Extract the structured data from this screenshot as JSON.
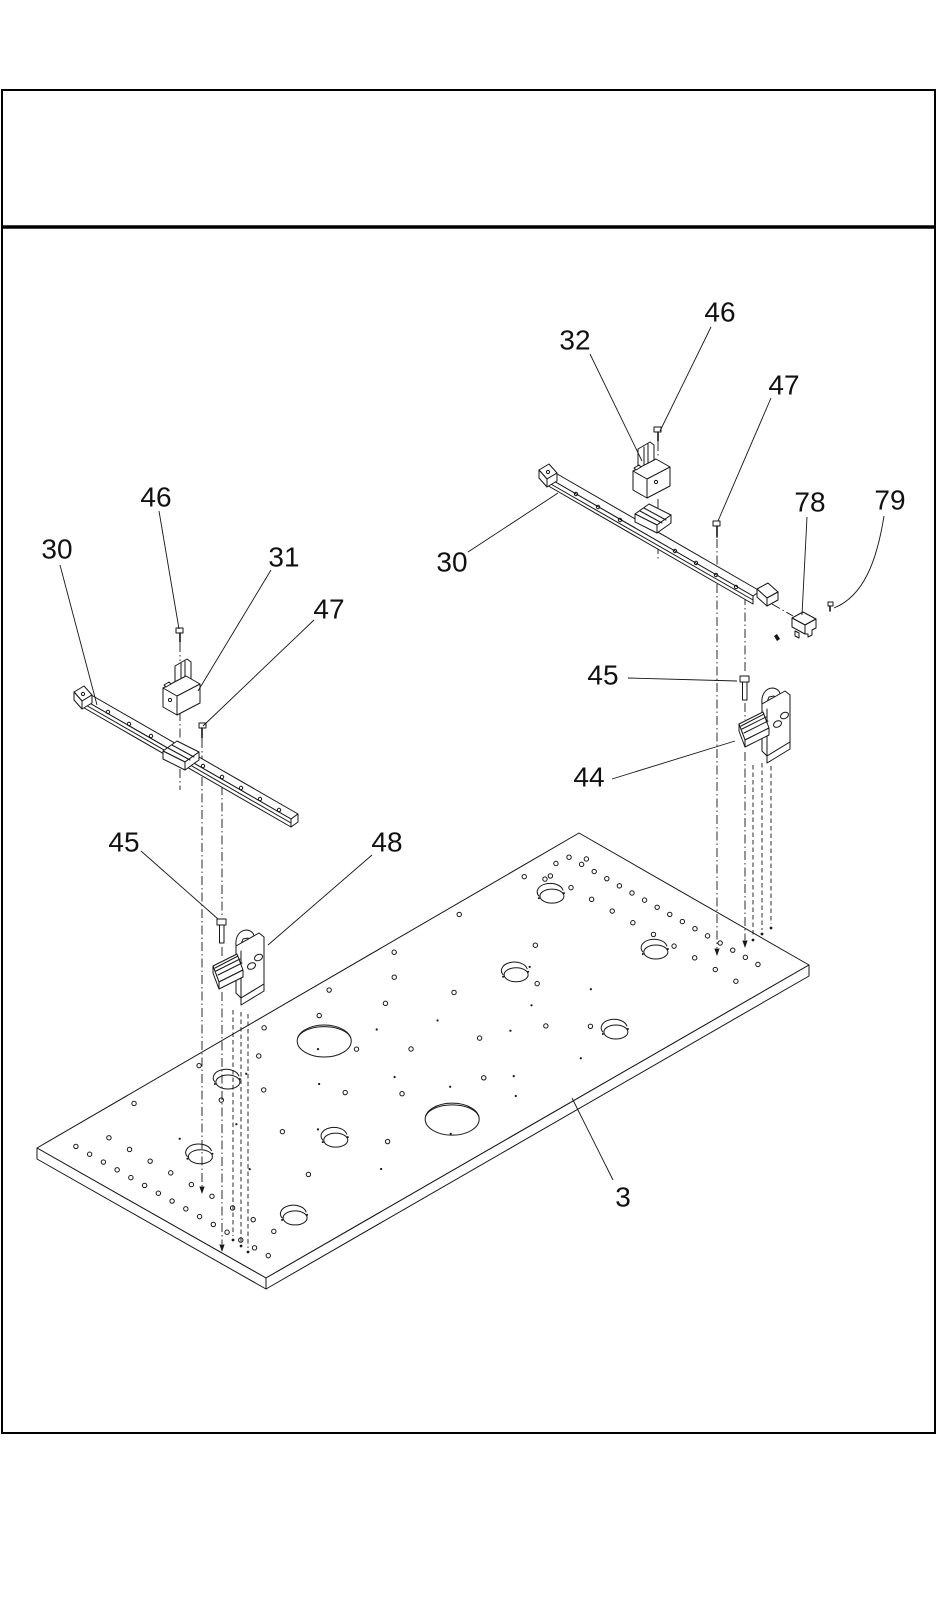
{
  "document": {
    "type": "exploded-parts-diagram",
    "page_color": "#ffffff",
    "ink_color": "#161616",
    "title_block_text": ""
  },
  "diagram": {
    "part_labels": [
      {
        "id": "46-upper-right",
        "text": "46",
        "x": 720,
        "y": 312,
        "leader": [
          711,
          327,
          660,
          431
        ]
      },
      {
        "id": "32",
        "text": "32",
        "x": 575,
        "y": 340,
        "leader": [
          590,
          354,
          642,
          461
        ]
      },
      {
        "id": "47-right",
        "text": "47",
        "x": 784,
        "y": 385,
        "leader": [
          771,
          398,
          718,
          521
        ]
      },
      {
        "id": "78",
        "text": "78",
        "x": 810,
        "y": 502,
        "leader": [
          807,
          517,
          802,
          615
        ]
      },
      {
        "id": "79",
        "text": "79",
        "x": 890,
        "y": 500,
        "curve": "M884,516 C877,560 864,596 834,608"
      },
      {
        "id": "30-right",
        "text": "30",
        "x": 452,
        "y": 562,
        "leader": [
          468,
          552,
          558,
          493
        ]
      },
      {
        "id": "46-upper-left",
        "text": "46",
        "x": 156,
        "y": 497,
        "leader": [
          159,
          511,
          179,
          629
        ]
      },
      {
        "id": "30-left",
        "text": "30",
        "x": 57,
        "y": 549,
        "leader": [
          60,
          565,
          97,
          705
        ]
      },
      {
        "id": "31",
        "text": "31",
        "x": 284,
        "y": 557,
        "leader": [
          271,
          570,
          198,
          691
        ]
      },
      {
        "id": "47-left",
        "text": "47",
        "x": 329,
        "y": 609,
        "leader": [
          314,
          620,
          203,
          726
        ]
      },
      {
        "id": "45-right",
        "text": "45",
        "x": 603,
        "y": 675,
        "leader": [
          628,
          678,
          737,
          681
        ]
      },
      {
        "id": "44",
        "text": "44",
        "x": 589,
        "y": 777,
        "leader": [
          612,
          779,
          735,
          741
        ]
      },
      {
        "id": "45-left",
        "text": "45",
        "x": 124,
        "y": 842,
        "leader": [
          141,
          851,
          218,
          919
        ]
      },
      {
        "id": "48",
        "text": "48",
        "x": 387,
        "y": 842,
        "leader": [
          372,
          855,
          268,
          945
        ]
      },
      {
        "id": "3",
        "text": "3",
        "x": 623,
        "y": 1197,
        "leader": [
          613,
          1180,
          572,
          1098
        ]
      }
    ],
    "plate": {
      "corners": {
        "top": [
          579,
          833
        ],
        "right": [
          809,
          965
        ],
        "bottom": [
          266,
          1278
        ],
        "left": [
          37,
          1148
        ]
      },
      "thickness": 11,
      "large_holes": [
        [
          0.437,
          0.22
        ],
        [
          0.428,
          0.8
        ]
      ],
      "keyholes": [
        [
          0.874,
          0.18
        ],
        [
          0.879,
          0.622
        ],
        [
          0.715,
          0.4
        ],
        [
          0.714,
          0.838
        ],
        [
          0.28,
          0.171
        ],
        [
          0.135,
          0.394
        ],
        [
          0.123,
          0.836
        ],
        [
          0.285,
          0.63
        ]
      ],
      "small_holes": [
        [
          0.952,
          0.07
        ],
        [
          0.952,
          0.125
        ],
        [
          0.952,
          0.18
        ],
        [
          0.952,
          0.235
        ],
        [
          0.952,
          0.29
        ],
        [
          0.952,
          0.345
        ],
        [
          0.952,
          0.4
        ],
        [
          0.952,
          0.455
        ],
        [
          0.952,
          0.51
        ],
        [
          0.952,
          0.565
        ],
        [
          0.952,
          0.62
        ],
        [
          0.952,
          0.675
        ],
        [
          0.952,
          0.73
        ],
        [
          0.952,
          0.785
        ],
        [
          0.952,
          0.84
        ],
        [
          0.952,
          0.895
        ],
        [
          0.905,
          0.1
        ],
        [
          0.905,
          0.19
        ],
        [
          0.905,
          0.28
        ],
        [
          0.905,
          0.37
        ],
        [
          0.905,
          0.46
        ],
        [
          0.905,
          0.55
        ],
        [
          0.905,
          0.64
        ],
        [
          0.905,
          0.73
        ],
        [
          0.905,
          0.82
        ],
        [
          0.905,
          0.91
        ],
        [
          0.038,
          0.08
        ],
        [
          0.038,
          0.14
        ],
        [
          0.038,
          0.2
        ],
        [
          0.038,
          0.26
        ],
        [
          0.038,
          0.32
        ],
        [
          0.038,
          0.38
        ],
        [
          0.038,
          0.44
        ],
        [
          0.038,
          0.5
        ],
        [
          0.038,
          0.56
        ],
        [
          0.038,
          0.62
        ],
        [
          0.038,
          0.68
        ],
        [
          0.038,
          0.74
        ],
        [
          0.038,
          0.8
        ],
        [
          0.038,
          0.86
        ],
        [
          0.038,
          0.92
        ],
        [
          0.082,
          0.12
        ],
        [
          0.082,
          0.21
        ],
        [
          0.082,
          0.3
        ],
        [
          0.082,
          0.39
        ],
        [
          0.082,
          0.48
        ],
        [
          0.082,
          0.57
        ],
        [
          0.082,
          0.66
        ],
        [
          0.082,
          0.75
        ],
        [
          0.082,
          0.84
        ],
        [
          0.16,
          0.045
        ],
        [
          0.28,
          0.045
        ],
        [
          0.4,
          0.045
        ],
        [
          0.52,
          0.045
        ],
        [
          0.64,
          0.045
        ],
        [
          0.76,
          0.045
        ],
        [
          0.88,
          0.045
        ],
        [
          0.93,
          0.065
        ],
        [
          0.965,
          0.115
        ],
        [
          0.895,
          0.1
        ],
        [
          0.55,
          0.22
        ],
        [
          0.63,
          0.33
        ],
        [
          0.5,
          0.45
        ],
        [
          0.58,
          0.56
        ],
        [
          0.45,
          0.33
        ],
        [
          0.37,
          0.47
        ],
        [
          0.3,
          0.28
        ],
        [
          0.66,
          0.66
        ],
        [
          0.52,
          0.72
        ],
        [
          0.42,
          0.6
        ],
        [
          0.25,
          0.48
        ],
        [
          0.205,
          0.7
        ],
        [
          0.33,
          0.75
        ],
        [
          0.72,
          0.48
        ],
        [
          0.78,
          0.33
        ],
        [
          0.7,
          0.76
        ],
        [
          0.6,
          0.14
        ],
        [
          0.47,
          0.12
        ],
        [
          0.35,
          0.14
        ],
        [
          0.245,
          0.225
        ]
      ],
      "dots": [
        [
          0.5,
          0.3
        ],
        [
          0.57,
          0.4
        ],
        [
          0.44,
          0.52
        ],
        [
          0.62,
          0.6
        ],
        [
          0.36,
          0.38
        ],
        [
          0.286,
          0.55
        ],
        [
          0.475,
          0.68
        ],
        [
          0.55,
          0.78
        ],
        [
          0.68,
          0.55
        ],
        [
          0.74,
          0.4
        ],
        [
          0.31,
          0.18
        ],
        [
          0.415,
          0.245
        ],
        [
          0.52,
          0.86
        ],
        [
          0.28,
          0.84
        ],
        [
          0.16,
          0.55
        ],
        [
          0.145,
          0.28
        ],
        [
          0.64,
          0.86
        ],
        [
          0.76,
          0.62
        ],
        [
          0.4,
          0.86
        ],
        [
          0.22,
          0.35
        ]
      ]
    },
    "rail_holes": [
      [
        108,
        712
      ],
      [
        129,
        724
      ],
      [
        151,
        736
      ],
      [
        203,
        766
      ],
      [
        222,
        777
      ],
      [
        241,
        788
      ],
      [
        260,
        799
      ],
      [
        279,
        810
      ],
      [
        576,
        494
      ],
      [
        598,
        507
      ],
      [
        620,
        520
      ],
      [
        675,
        551
      ],
      [
        696,
        563
      ],
      [
        716,
        575
      ],
      [
        736,
        587
      ]
    ],
    "centerlines": [
      {
        "x": 180,
        "style": "dashdot",
        "segs": [
          [
            643,
            661
          ],
          [
            712,
            740
          ],
          [
            769,
            790
          ]
        ]
      },
      {
        "x": 202,
        "style": "dashdot",
        "segs": [
          [
            739,
            762
          ],
          [
            777,
            1186
          ]
        ],
        "arrow": 1194
      },
      {
        "x": 222,
        "style": "dashdot",
        "segs": [
          [
            786,
            917
          ],
          [
            947,
            957
          ],
          [
            992,
            1244
          ]
        ],
        "arrow": 1252
      },
      {
        "x": 233,
        "style": "dashed",
        "segs": [
          [
            1010,
            1236
          ]
        ],
        "dot": 1240
      },
      {
        "x": 241,
        "style": "dashed",
        "segs": [
          [
            1012,
            1242
          ]
        ],
        "dot": 1246
      },
      {
        "x": 248,
        "style": "dashed",
        "segs": [
          [
            1014,
            1248
          ]
        ],
        "dot": 1252
      },
      {
        "x": 658,
        "style": "dashdot",
        "segs": [
          [
            442,
            458
          ],
          [
            499,
            512
          ],
          [
            545,
            560
          ]
        ]
      },
      {
        "x": 717,
        "style": "dashdot",
        "segs": [
          [
            539,
            570
          ],
          [
            584,
            948
          ]
        ],
        "arrow": 956
      },
      {
        "x": 745,
        "style": "dashdot",
        "segs": [
          [
            596,
            674
          ],
          [
            703,
            720
          ],
          [
            752,
            940
          ]
        ],
        "arrow": 948
      },
      {
        "x": 753,
        "style": "dashed",
        "segs": [
          [
            765,
            936
          ]
        ],
        "dot": 940
      },
      {
        "x": 762,
        "style": "dashed",
        "segs": [
          [
            763,
            930
          ]
        ],
        "dot": 934
      },
      {
        "x": 771,
        "style": "dashed",
        "segs": [
          [
            766,
            924
          ]
        ],
        "dot": 928
      }
    ],
    "diagonal_centerline": {
      "x1": 772,
      "y1": 604,
      "x2": 793,
      "y2": 616
    }
  }
}
